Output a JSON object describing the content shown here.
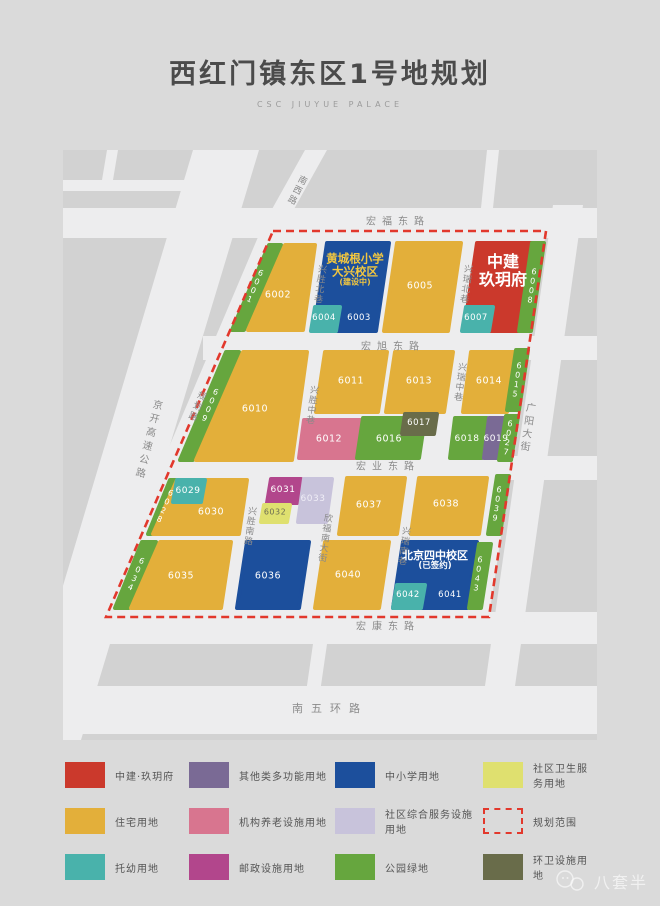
{
  "page": {
    "title": "西红门镇东区1号地规划",
    "subtitle": "CSC JIUYUE PALACE",
    "watermark": "八套半"
  },
  "colors": {
    "res": "#e3af3a",
    "project": "#cb392c",
    "school": "#1c4f9c",
    "kind": "#49b2ab",
    "park": "#66a63e",
    "multi": "#7a6a95",
    "elderly": "#d8758f",
    "postal": "#b2468c",
    "community": "#c8c3db",
    "health": "#dfe06f",
    "sanitation": "#696c4a",
    "boundary": "#e2382c",
    "road": "#ededee",
    "block": "#d2d2d2",
    "road_label": "#8a8a8a"
  },
  "map": {
    "roads": [
      {
        "name": "宏福东路",
        "x": 335,
        "y": 72,
        "ls": 6,
        "size": 10
      },
      {
        "name": "宏旭东路",
        "x": 330,
        "y": 197,
        "ls": 6,
        "size": 10
      },
      {
        "name": "宏业东路",
        "x": 325,
        "y": 317,
        "ls": 6,
        "size": 10
      },
      {
        "name": "宏康东路",
        "x": 325,
        "y": 477,
        "ls": 6,
        "size": 10
      },
      {
        "name": "南五环路",
        "x": 267,
        "y": 559,
        "ls": 8,
        "size": 11
      },
      {
        "name": "南西路",
        "x": 233,
        "y": 40,
        "vert": true,
        "rot": 27,
        "size": 9,
        "ls": 2
      },
      {
        "name": "规划路",
        "x": 133,
        "y": 256,
        "vert": true,
        "rot": 23,
        "size": 9,
        "ls": 2
      },
      {
        "name": "京开高速公路",
        "x": 84,
        "y": 290,
        "vert": true,
        "rot": 14,
        "size": 10,
        "ls": 4
      },
      {
        "name": "广阳大街",
        "x": 463,
        "y": 278,
        "vert": true,
        "rot": 8,
        "size": 10,
        "ls": 3
      },
      {
        "name": "兴胜北巷",
        "x": 256,
        "y": 134,
        "vert": true,
        "rot": 8,
        "size": 9,
        "ls": 1
      },
      {
        "name": "兴瑞北巷",
        "x": 402,
        "y": 134,
        "vert": true,
        "rot": 8,
        "size": 9,
        "ls": 1
      },
      {
        "name": "兴胜中巷",
        "x": 248,
        "y": 255,
        "vert": true,
        "rot": 8,
        "size": 9,
        "ls": 1
      },
      {
        "name": "兴瑞中巷",
        "x": 396,
        "y": 232,
        "vert": true,
        "rot": 8,
        "size": 9,
        "ls": 1
      },
      {
        "name": "兴胜南路",
        "x": 186,
        "y": 376,
        "vert": true,
        "rot": 8,
        "size": 9,
        "ls": 1
      },
      {
        "name": "欣福南大街",
        "x": 261,
        "y": 388,
        "vert": true,
        "rot": 8,
        "size": 9,
        "ls": 1
      },
      {
        "name": "兴瑞南巷",
        "x": 340,
        "y": 396,
        "vert": true,
        "rot": 8,
        "size": 9,
        "ls": 1
      }
    ],
    "parcels": [
      {
        "id": "6001",
        "type": "park",
        "poly": "206,95 218,95 181,180 169,180",
        "lp": [
          191,
          136
        ],
        "rot": 23,
        "vert": true,
        "size": 8
      },
      {
        "id": "6002",
        "type": "res",
        "poly": "222,95 252,95 240,180 185,180",
        "lp": [
          215,
          146
        ]
      },
      {
        "name": "huangchenggen-school",
        "type": "school",
        "poly": "264,93 326,93 313,181 251,181"
      },
      {
        "id": "6004",
        "type": "kind",
        "poly": "252,157 277,157 273,181 248,181",
        "lp": [
          261,
          169
        ],
        "size": 8.5
      },
      {
        "id": "6003",
        "lp": [
          296,
          169
        ],
        "size": 8.5
      },
      {
        "id": "6005",
        "type": "res",
        "poly": "334,93 398,93 385,181 321,181",
        "lp": [
          357,
          137
        ]
      },
      {
        "name": "zhongjian-jiuyuefu",
        "type": "project",
        "poly": "414,93 476,93 463,181 401,181"
      },
      {
        "id": "6007",
        "type": "kind",
        "poly": "403,157 430,157 426,181 399,181",
        "lp": [
          413,
          169
        ],
        "size": 8.5
      },
      {
        "id": "6008",
        "type": "park",
        "poly": "469,93 481,93 468,181 456,181",
        "lp": [
          468,
          136
        ],
        "rot": 8,
        "vert": true,
        "size": 8
      },
      {
        "id": "6009",
        "type": "park",
        "poly": "163,202 176,202 130,310 117,310",
        "lp": [
          146,
          255
        ],
        "rot": 23,
        "vert": true,
        "size": 8
      },
      {
        "id": "6010",
        "type": "res",
        "poly": "180,202 244,202 229,310 133,310",
        "lp": [
          192,
          260
        ]
      },
      {
        "id": "6011",
        "type": "res",
        "poly": "262,202 324,202 315,262 253,262",
        "lp": [
          288,
          232
        ]
      },
      {
        "id": "6012",
        "type": "elderly",
        "poly": "241,270 301,270 296,308 236,308",
        "lp": [
          266,
          290
        ]
      },
      {
        "id": "6013",
        "type": "res",
        "poly": "332,202 390,202 381,262 323,262",
        "lp": [
          356,
          232
        ]
      },
      {
        "id": "6014",
        "type": "res",
        "poly": "408,202 452,202 444,262 400,262",
        "lp": [
          426,
          232
        ]
      },
      {
        "id": "6015",
        "type": "park",
        "poly": "453,200 465,200 456,260 444,260",
        "lp": [
          453,
          230
        ],
        "rot": 8,
        "vert": true,
        "size": 8
      },
      {
        "id": "6016",
        "type": "park",
        "poly": "300,268 362,268 356,308 294,308",
        "lp": [
          326,
          290
        ]
      },
      {
        "id": "6017",
        "type": "sanitation",
        "poly": "342,264 374,264 371,284 339,284",
        "lp": [
          356,
          274
        ],
        "size": 8.5
      },
      {
        "id": "6018",
        "type": "park",
        "poly": "392,268 424,268 419,308 387,308",
        "lp": [
          404,
          289
        ],
        "size": 9
      },
      {
        "id": "6019",
        "type": "multi",
        "poly": "426,268 448,268 443,308 421,308",
        "lp": [
          433,
          289
        ],
        "size": 9
      },
      {
        "id": "6027",
        "type": "park",
        "poly": "443,266 455,266 448,310 436,310",
        "lp": [
          444,
          288
        ],
        "rot": 8,
        "vert": true,
        "size": 8
      },
      {
        "id": "6028",
        "type": "park",
        "poly": "107,330 120,330 98,384 85,384",
        "lp": [
          101,
          356
        ],
        "rot": 23,
        "vert": true,
        "size": 8
      },
      {
        "id": "6030",
        "type": "res",
        "poly": "114,330 184,330 176,384 90,384",
        "lp": [
          148,
          363
        ]
      },
      {
        "id": "6029",
        "type": "kind",
        "poly": "114,330 142,330 138,352 110,352",
        "lp": [
          125,
          341
        ],
        "size": 9
      },
      {
        "id": "6031",
        "type": "postal",
        "poly": "208,329 238,329 234,353 204,353",
        "lp": [
          220,
          340
        ],
        "size": 9
      },
      {
        "id": "6032",
        "type": "health",
        "poly": "201,355 227,355 224,372 198,372",
        "lp": [
          212,
          363
        ],
        "size": 8,
        "label_color": "#6d6d52"
      },
      {
        "id": "6033",
        "type": "community",
        "poly": "241,329 269,329 263,372 235,372",
        "lp": [
          250,
          349
        ],
        "size": 9,
        "label_color": "#efedf6"
      },
      {
        "id": "6037",
        "type": "res",
        "poly": "284,328 342,328 334,384 276,384",
        "lp": [
          306,
          356
        ]
      },
      {
        "id": "6038",
        "type": "res",
        "poly": "356,328 424,328 416,384 348,384",
        "lp": [
          383,
          355
        ]
      },
      {
        "id": "6039",
        "type": "park",
        "poly": "434,326 446,326 437,384 425,384",
        "lp": [
          433,
          354
        ],
        "rot": 8,
        "vert": true,
        "size": 8
      },
      {
        "id": "6034",
        "type": "park",
        "poly": "79,392 93,392 66,458 52,458",
        "lp": [
          72,
          424
        ],
        "rot": 23,
        "vert": true,
        "size": 8
      },
      {
        "id": "6035",
        "type": "res",
        "poly": "97,392 168,392 158,458 68,458",
        "lp": [
          118,
          427
        ]
      },
      {
        "id": "6036",
        "type": "school",
        "poly": "184,392 246,392 236,458 174,458",
        "lp": [
          205,
          427
        ]
      },
      {
        "id": "6040",
        "type": "res",
        "poly": "262,392 326,392 316,458 252,458",
        "lp": [
          285,
          426
        ]
      },
      {
        "name": "beijing-sizhong-school",
        "type": "school",
        "poly": "340,392 414,392 404,458 330,458"
      },
      {
        "id": "6042",
        "type": "kind",
        "poly": "334,435 362,435 358,458 330,458",
        "lp": [
          345,
          446
        ],
        "size": 8.5
      },
      {
        "id": "6041",
        "lp": [
          387,
          446
        ],
        "size": 8.5
      },
      {
        "id": "6043",
        "type": "park",
        "poly": "416,394 428,394 418,458 406,458",
        "lp": [
          414,
          424
        ],
        "rot": 8,
        "vert": true,
        "size": 8
      }
    ],
    "landmarks": [
      {
        "name": "huangchenggen-school-label",
        "lines": [
          "黄城根小学",
          "大兴校区",
          "(建设中)"
        ],
        "sizes": [
          11.5,
          11.5,
          8
        ],
        "x": 292,
        "y": 120,
        "color": "#f3c73f"
      },
      {
        "name": "zhongjian-jiuyuefu-label",
        "lines": [
          "中建",
          "玖玥府"
        ],
        "sizes": [
          16,
          16
        ],
        "x": 440,
        "y": 121,
        "color": "#ffffff"
      },
      {
        "name": "beijing-sizhong-label",
        "lines": [
          "北京四中校区",
          "(已签约)"
        ],
        "sizes": [
          11,
          8.5
        ],
        "x": 372,
        "y": 411,
        "color": "#ffffff"
      }
    ]
  },
  "legend": {
    "items": [
      {
        "label": "中建·玖玥府",
        "key": "project"
      },
      {
        "label": "其他类多功能用地",
        "key": "multi"
      },
      {
        "label": "中小学用地",
        "key": "school"
      },
      {
        "label": "社区卫生服务用地",
        "key": "health"
      },
      {
        "label": "住宅用地",
        "key": "res"
      },
      {
        "label": "机构养老设施用地",
        "key": "elderly"
      },
      {
        "label": "社区综合服务设施用地",
        "key": "community"
      },
      {
        "label": "规划范围",
        "key": "boundary"
      },
      {
        "label": "托幼用地",
        "key": "kind"
      },
      {
        "label": "邮政设施用地",
        "key": "postal"
      },
      {
        "label": "公园绿地",
        "key": "park"
      },
      {
        "label": "环卫设施用地",
        "key": "sanitation"
      }
    ]
  }
}
